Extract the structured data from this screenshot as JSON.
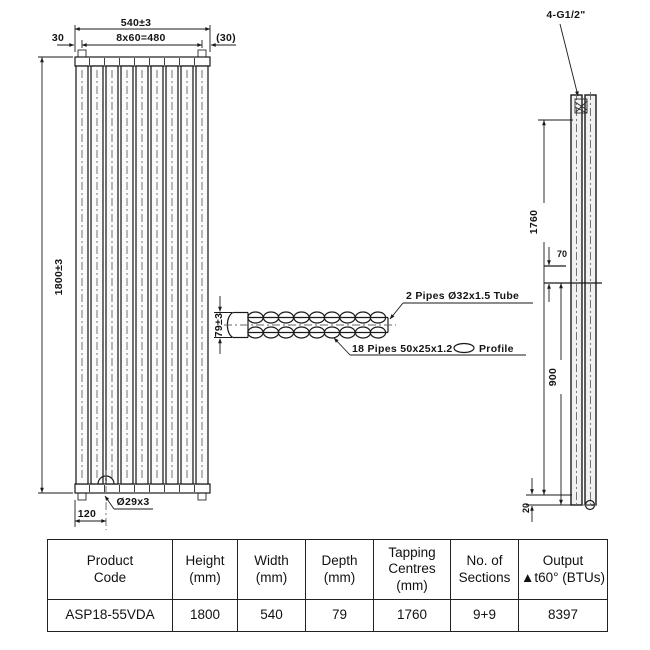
{
  "front_view": {
    "dim_width": "540±3",
    "dim_left": "30",
    "dim_spacing": "8x60=480",
    "dim_right": "(30)",
    "dim_height": "1800±3",
    "dim_bottom": "120",
    "dim_vent": "Ø29x3"
  },
  "section_view": {
    "dim_depth": "79±3",
    "tube_label": "2 Pipes Ø32x1.5 Tube",
    "pipes_label": "18 Pipes 50x25x1.2",
    "profile_label": "Profile"
  },
  "side_view": {
    "tapping_label": "4-G1/2\"",
    "dim_centres": "1760",
    "dim_offset": "70",
    "dim_span": "900",
    "dim_bottom": "20"
  },
  "table": {
    "headers": [
      {
        "lines": [
          "Product",
          "Code",
          ""
        ]
      },
      {
        "lines": [
          "Height",
          "(mm)",
          ""
        ]
      },
      {
        "lines": [
          "Width",
          "(mm)",
          ""
        ]
      },
      {
        "lines": [
          "Depth",
          "(mm)",
          ""
        ]
      },
      {
        "lines": [
          "Tapping",
          "Centres",
          "(mm)"
        ]
      },
      {
        "lines": [
          "No. of",
          "Sections",
          ""
        ]
      },
      {
        "lines": [
          "Output",
          "▲t60° (BTUs)",
          ""
        ]
      }
    ],
    "row": [
      "ASP18-55VDA",
      "1800",
      "540",
      "79",
      "1760",
      "9+9",
      "8397"
    ]
  }
}
